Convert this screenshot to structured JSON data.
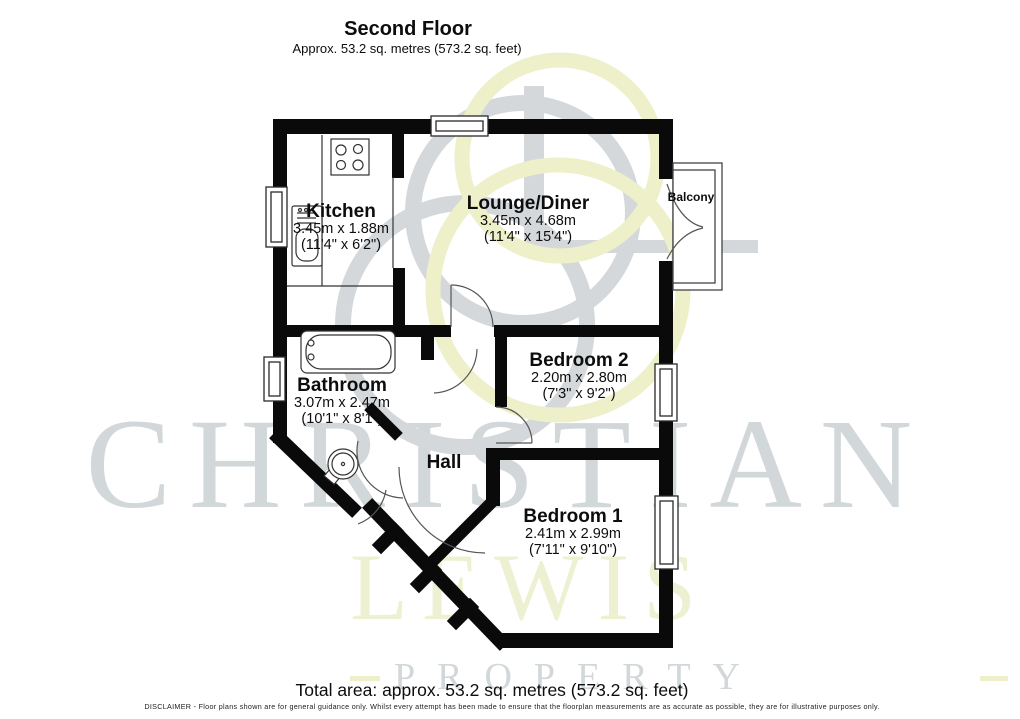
{
  "header": {
    "title": "Second Floor",
    "subtitle": "Approx. 53.2 sq. metres (573.2 sq. feet)"
  },
  "rooms": {
    "kitchen": {
      "name": "Kitchen",
      "metric": "3.45m x 1.88m",
      "imperial": "(11'4\" x 6'2\")"
    },
    "lounge": {
      "name": "Lounge/Diner",
      "metric": "3.45m x 4.68m",
      "imperial": "(11'4\" x 15'4\")"
    },
    "bathroom": {
      "name": "Bathroom",
      "metric": "3.07m x 2.47m",
      "imperial": "(10'1\" x 8'1\")"
    },
    "bedroom2": {
      "name": "Bedroom 2",
      "metric": "2.20m x 2.80m",
      "imperial": "(7'3\" x 9'2\")"
    },
    "bedroom1": {
      "name": "Bedroom 1",
      "metric": "2.41m x 2.99m",
      "imperial": "(7'11\" x 9'10\")"
    },
    "hall": {
      "name": "Hall"
    },
    "balcony": {
      "name": "Balcony"
    }
  },
  "watermark": {
    "brand_line1": "CHRISTIAN",
    "brand_line2": "LEWIS",
    "brand_line3": "PROPERTY"
  },
  "footer": {
    "total_area": "Total area: approx. 53.2 sq. metres (573.2 sq. feet)",
    "disclaimer": "DISCLAIMER -  Floor plans shown are for general guidance only. Whilst every attempt has been made to ensure that the floorplan measurements are as accurate as possible, they are for illustrative purposes only."
  },
  "colors": {
    "wall_black": "#0a0a0a",
    "watermark_gray": "#d2d7da",
    "watermark_yellow": "#edf0c8"
  }
}
